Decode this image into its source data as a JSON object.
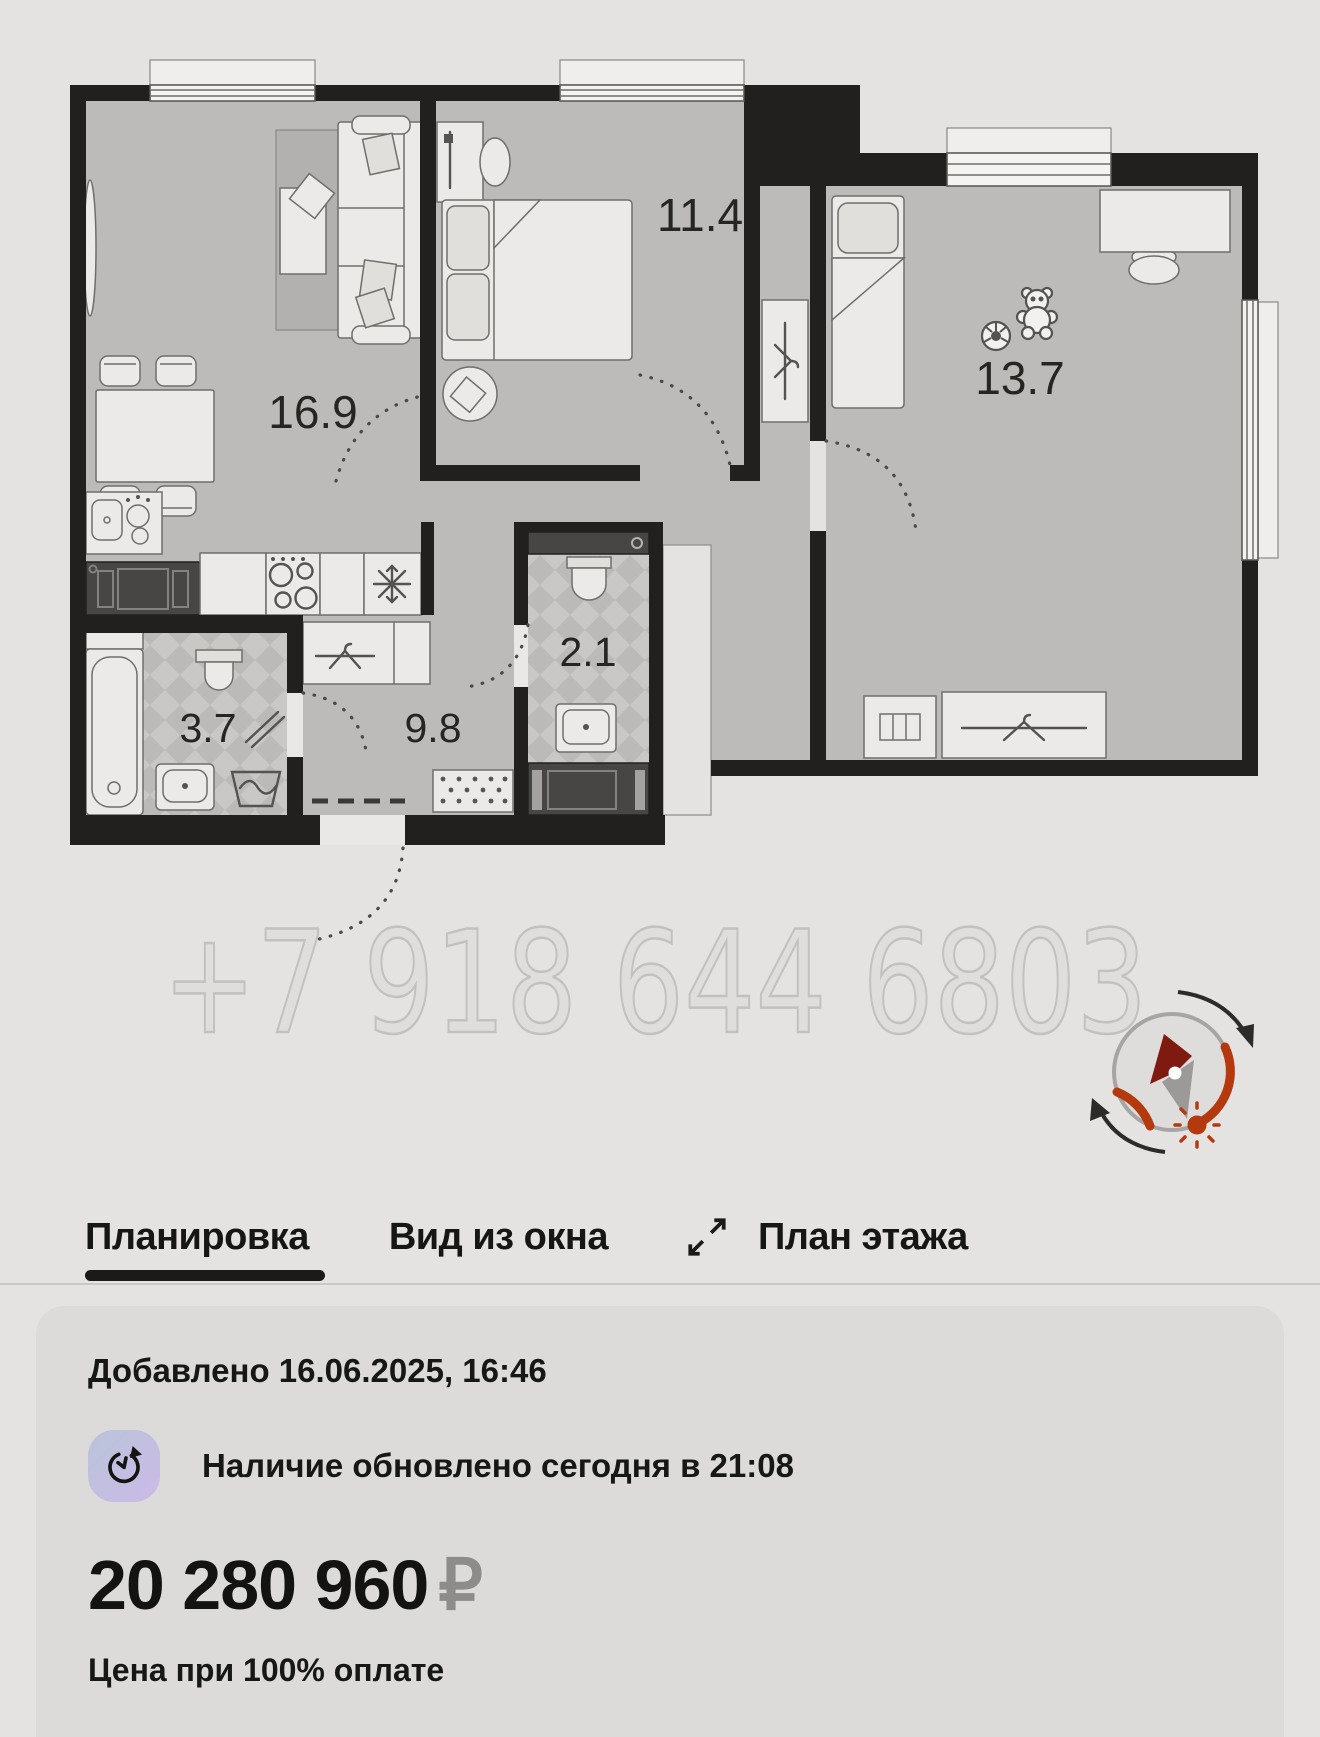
{
  "floorplan": {
    "watermark": "+7 918 644 6803",
    "rooms": [
      {
        "name": "living-room",
        "area": "16.9"
      },
      {
        "name": "bedroom",
        "area": "11.4"
      },
      {
        "name": "kids-room",
        "area": "13.7"
      },
      {
        "name": "bathroom",
        "area": "3.7"
      },
      {
        "name": "hallway",
        "area": "9.8"
      },
      {
        "name": "wc",
        "area": "2.1"
      }
    ],
    "icons": [
      "compass-icon",
      "sun-icon",
      "north-needle-icon",
      "snowflake-icon",
      "hanger-icon",
      "teddy-bear-icon",
      "soccer-ball-icon"
    ]
  },
  "tabs": {
    "items": [
      {
        "label": "Планировка",
        "active": true
      },
      {
        "label": "Вид из окна",
        "active": false
      },
      {
        "label": "План этажа",
        "active": false,
        "icon": "expand-icon"
      }
    ]
  },
  "card": {
    "added": "Добавлено 16.06.2025, 16:46",
    "availability": "Наличие обновлено сегодня в 21:08",
    "availability_icon": "clock-refresh-icon",
    "price": "20 280 960",
    "currency": "₽",
    "note": "Цена при 100% оплате"
  },
  "colors": {
    "page_bg": "#e4e3e1",
    "card_bg": "#dcdbd9",
    "text_dark": "#171715",
    "currency_gray": "#8d8c8a",
    "active_underline": "#1b1a18",
    "compass_red": "#b5390e",
    "needle_red": "#7e1a10",
    "clock_icon_gradient": [
      "#b9c4da",
      "#ccbae7"
    ]
  }
}
